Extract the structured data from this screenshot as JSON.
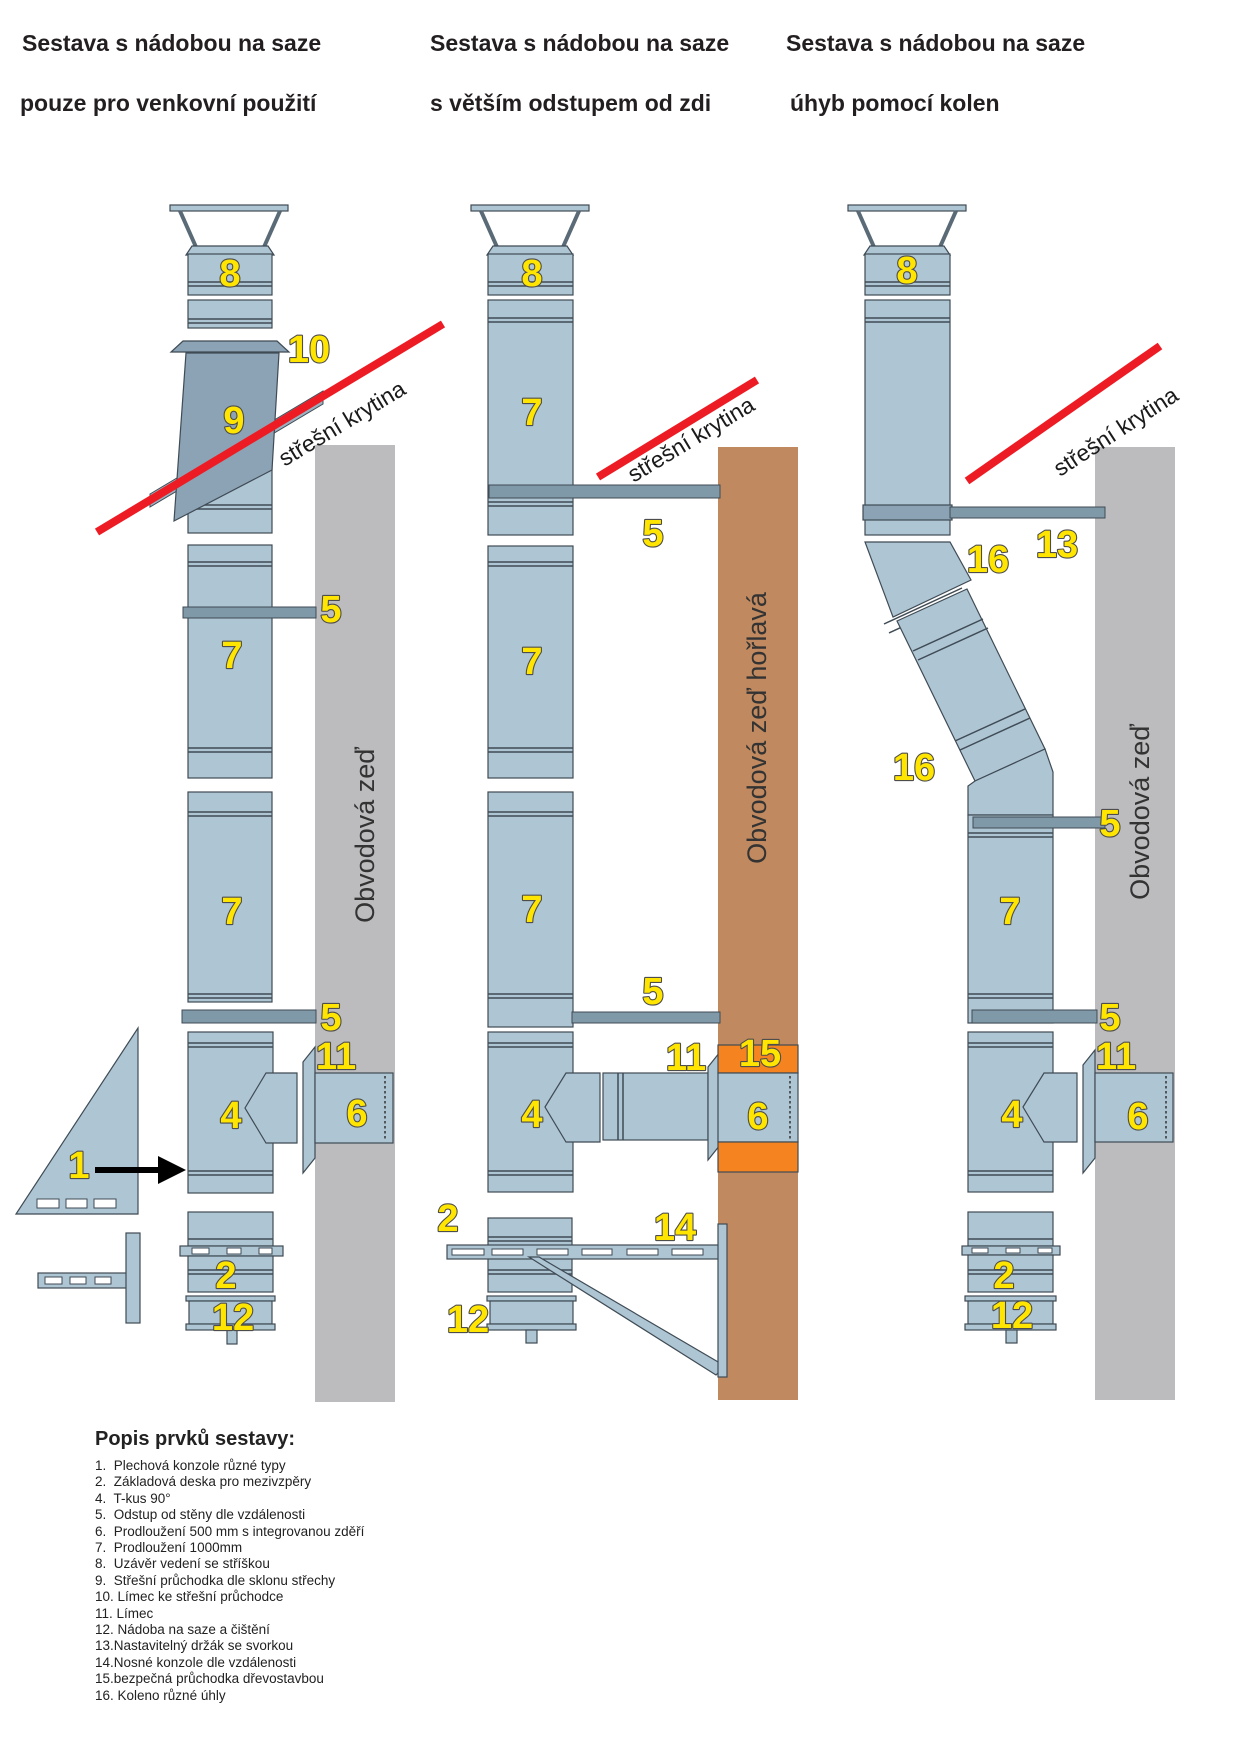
{
  "titles": [
    {
      "line1": "Sestava s nádobou na saze",
      "line2": "pouze pro venkovní použití"
    },
    {
      "line1": "Sestava s nádobou na saze",
      "line2": "s větším odstupem od zdi"
    },
    {
      "line1": "Sestava s nádobou na saze",
      "line2": "úhyb pomocí kolen"
    }
  ],
  "roof_covering_label": "střešní krytina",
  "walls": [
    {
      "label": "Obvodová zeď"
    },
    {
      "label": "Obvodová zeď hořlavá"
    },
    {
      "label": "Obvodová zeď"
    }
  ],
  "diagrams": [
    {
      "labels": [
        "8",
        "10",
        "9",
        "5",
        "7",
        "7",
        "5",
        "11",
        "4",
        "6",
        "1",
        "2",
        "12"
      ]
    },
    {
      "labels": [
        "8",
        "7",
        "5",
        "7",
        "7",
        "5",
        "11",
        "15",
        "4",
        "6",
        "2",
        "14",
        "12"
      ]
    },
    {
      "labels": [
        "8",
        "16",
        "13",
        "16",
        "5",
        "7",
        "5",
        "11",
        "4",
        "6",
        "2",
        "12"
      ]
    }
  ],
  "legend": {
    "heading": "Popis prvků sestavy:",
    "items": [
      "1.  Plechová konzole různé typy",
      "2.  Základová deska pro mezivzpěry",
      "4.  T-kus 90°",
      "5.  Odstup od stěny dle vzdálenosti",
      "6.  Prodloužení 500 mm s integrovanou zděří",
      "7.  Prodloužení 1000mm",
      "8.  Uzávěr vedení se stříškou",
      "9.  Střešní průchodka dle sklonu střechy",
      "10. Límec ke střešní průchodce",
      "11. Límec",
      "12. Nádoba na saze a čištění",
      "13.Nastavitelný držák se svorkou",
      "14.Nosné konzole dle vzdálenosti",
      "15.bezpečná průchodka dřevostavbou",
      "16. Koleno různé úhly"
    ]
  },
  "colors": {
    "pipe": "#aec5d3",
    "pipe_dark": "#8ba3b5",
    "skirt": "#9bb1c0",
    "bracket": "#7f99a8",
    "wall_gray": "#bcbcbe",
    "wall_brown": "#c0895f",
    "orange": "#f5831f",
    "roof_red": "#ed1c24",
    "number_fill": "#ffe500",
    "number_outline": "#4d4d4d",
    "outline": "#3f4b55",
    "title_text": "#231f20"
  }
}
